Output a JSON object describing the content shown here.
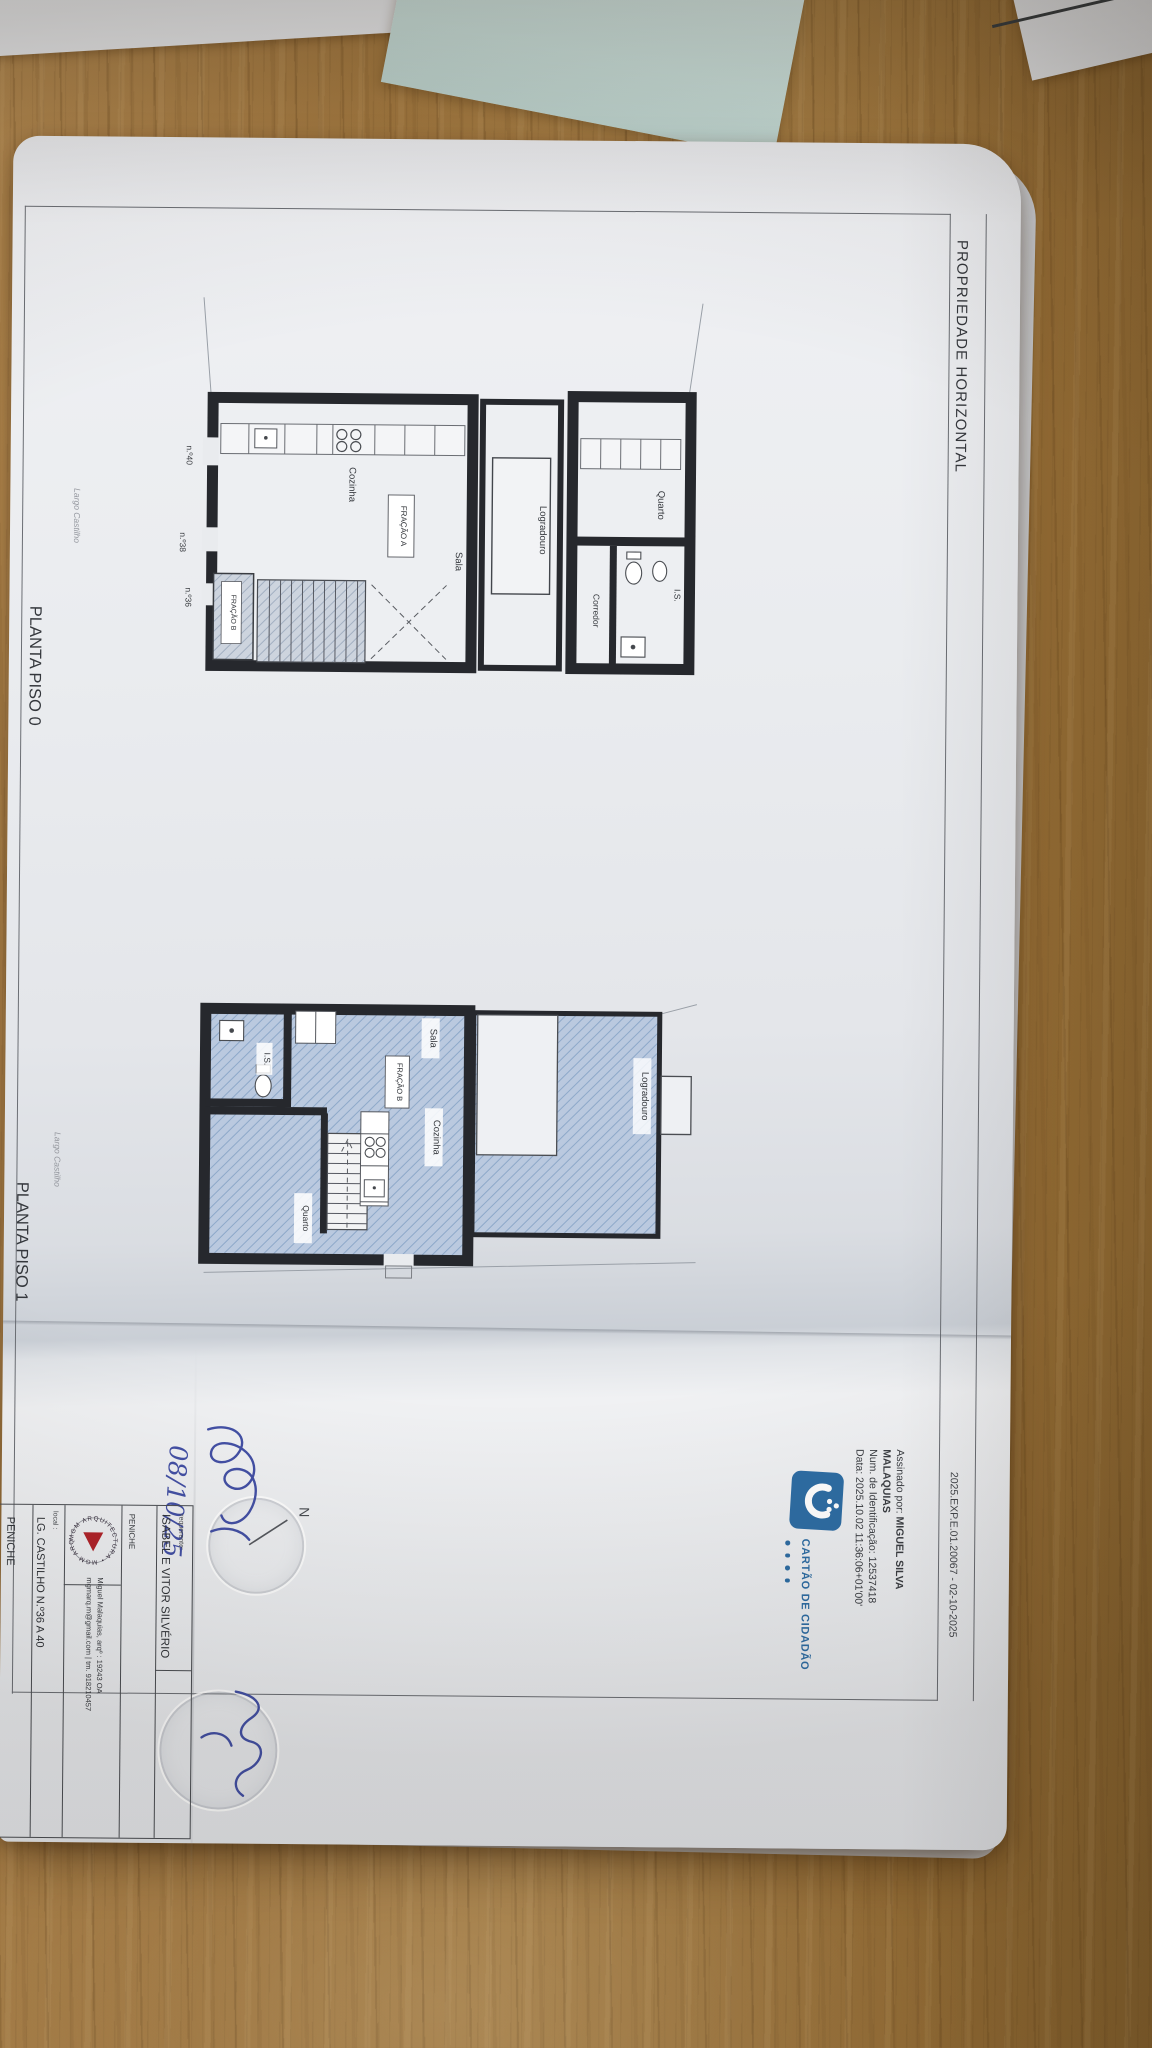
{
  "header": {
    "title": "PROPRIEDADE HORIZONTAL",
    "reference": "2025.EXP.E.01.20067 - 02-10-2025"
  },
  "digital_signature": {
    "signed_by_label": "Assinado por: ",
    "signed_by_name": "MIGUEL SILVA",
    "signed_by_name2": "MALAQUIAS",
    "id_line": "Num. de Identificação: 12537418",
    "date_line": "Data: 2025.10.02 11:36:06+01'00'",
    "card_label": "CARTÃO DE CIDADÃO"
  },
  "piso0": {
    "title": "PLANTA PISO 0",
    "street": "Largo Castilho",
    "rooms": {
      "cozinha": "Cozinha",
      "sala": "Sala",
      "logradouro": "Logradouro",
      "quarto": "Quarto",
      "corredor": "Corredor",
      "is": "I.S.",
      "fracao_a": "FRAÇÃO A",
      "fracao_b": "FRAÇÃO B"
    },
    "doors": {
      "n40": "n.º40",
      "n38": "n.º38",
      "n36": "n.º36"
    }
  },
  "piso1": {
    "title": "PLANTA PISO 1",
    "street": "Largo Castilho",
    "rooms": {
      "is": "I.S.",
      "sala": "Sala",
      "cozinha": "Cozinha",
      "quarto": "Quarto",
      "logradouro": "Logradouro",
      "fracao_b": "FRAÇÃO B"
    }
  },
  "title_block": {
    "requerente_label": "requerente:",
    "requerente_name": "ISABEL E VITOR SILVÉRIO",
    "city_small": "PENICHE",
    "logo_circle_text": "MGM ARQUITECTURA • MGM ARQUITECTURA •",
    "architect_line1": "Miguel Malaquias, arqº : 19243 OA",
    "architect_line2": "mgmarq.m@gmail.com  |  tm. 918210457",
    "local_label": "local :",
    "local_value": "LG. CASTILHO N.º36 A 40",
    "local_city": "PENICHE"
  },
  "annotations": {
    "handwritten_date": "08/10/25",
    "north_label": "N"
  },
  "colors": {
    "card_blue": "#2e6da4",
    "logo_red": "#b0232a",
    "hatch_blue": "#b9c9df",
    "wall": "#26282d",
    "ink_blue": "#4350a5"
  }
}
